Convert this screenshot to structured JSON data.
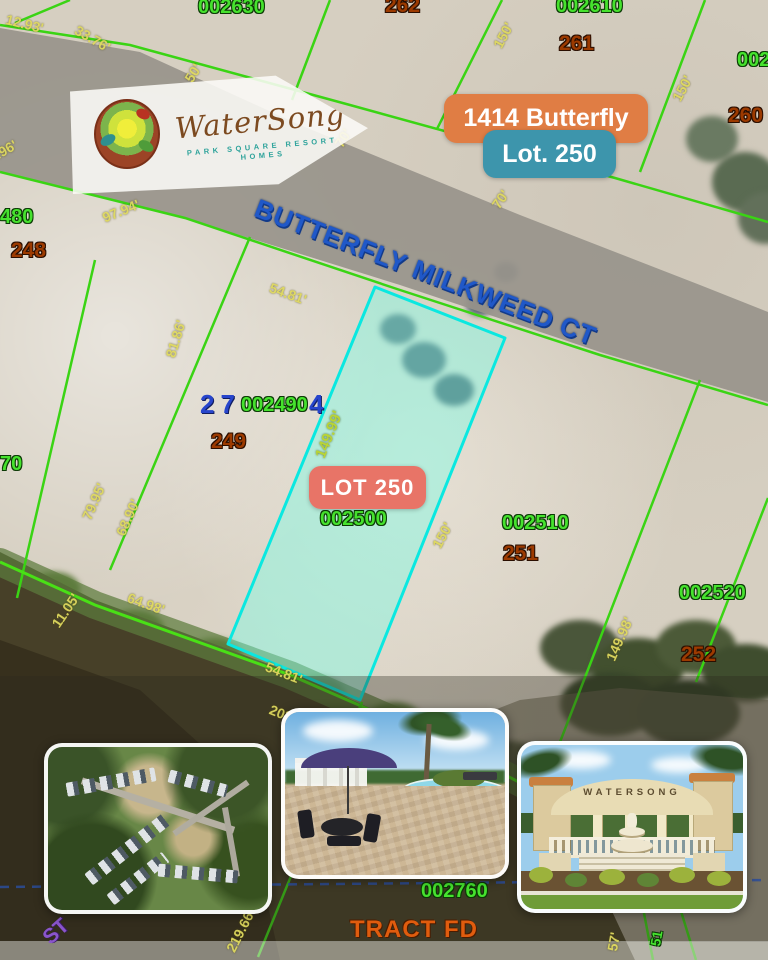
{
  "banner": {
    "brand": "WaterSong",
    "tagline": "PARK SQUARE RESORT HOMES"
  },
  "callouts": {
    "address": "1414 Butterfly",
    "lot": "Lot. 250",
    "lot_marker": "LOT 250"
  },
  "street": {
    "name": "BUTTERFLY MILKWEED CT"
  },
  "photos": {
    "entrance_sign": "WATERSONG"
  },
  "colors": {
    "accent_orange": "#e07d44",
    "accent_teal": "#3d95ac",
    "lot_marker_red": "#ec6a5e",
    "parcel_green": "#3ad414",
    "highlight_cyan": "#0ae8e0",
    "street_blue": "#2058c8",
    "dim_yellow": "#ded85e",
    "lot_number_brown": "#9c3a00",
    "road_gray": "#98948b"
  },
  "map_labels": [
    {
      "text": "002630",
      "x": 198,
      "y": -3,
      "cls": "p",
      "name": "parcel-id-002630"
    },
    {
      "text": "262",
      "x": 385,
      "y": -5,
      "cls": "n",
      "name": "lot-number-262"
    },
    {
      "text": "002610",
      "x": 556,
      "y": -4,
      "cls": "p",
      "name": "parcel-id-002610"
    },
    {
      "text": "261",
      "x": 559,
      "y": 33,
      "cls": "n",
      "name": "lot-number-261"
    },
    {
      "text": "002",
      "x": 737,
      "y": 50,
      "cls": "p",
      "name": "parcel-id-partial-right"
    },
    {
      "text": "260",
      "x": 728,
      "y": 105,
      "cls": "n",
      "name": "lot-number-260"
    },
    {
      "text": "480",
      "x": 0,
      "y": 207,
      "cls": "p",
      "name": "parcel-id-partial-480"
    },
    {
      "text": "248",
      "x": 11,
      "y": 240,
      "cls": "n",
      "name": "lot-number-248"
    },
    {
      "text": "70",
      "x": 0,
      "y": 454,
      "cls": "p",
      "name": "parcel-id-partial-70"
    },
    {
      "text": "27",
      "x": 200,
      "y": 391,
      "cls": "b",
      "name": "overlap-blue-27"
    },
    {
      "text": "002490",
      "x": 241,
      "y": 395,
      "cls": "p",
      "name": "parcel-id-002490"
    },
    {
      "text": "4",
      "x": 309,
      "y": 391,
      "cls": "b",
      "name": "overlap-blue-4"
    },
    {
      "text": "249",
      "x": 211,
      "y": 431,
      "cls": "n",
      "name": "lot-number-249"
    },
    {
      "text": "002500",
      "x": 320,
      "y": 509,
      "cls": "p",
      "name": "parcel-id-002500"
    },
    {
      "text": "002510",
      "x": 502,
      "y": 513,
      "cls": "p",
      "name": "parcel-id-002510"
    },
    {
      "text": "251",
      "x": 503,
      "y": 543,
      "cls": "n",
      "name": "lot-number-251"
    },
    {
      "text": "002520",
      "x": 679,
      "y": 583,
      "cls": "p",
      "name": "parcel-id-002520"
    },
    {
      "text": "252",
      "x": 681,
      "y": 644,
      "cls": "n",
      "name": "lot-number-252"
    },
    {
      "text": "002760",
      "x": 421,
      "y": 881,
      "cls": "p",
      "name": "parcel-id-002760"
    },
    {
      "text": "TRACT FD",
      "x": 350,
      "y": 918,
      "cls": "t",
      "name": "tract-label"
    },
    {
      "text": "ST",
      "x": 46,
      "y": 930,
      "cls": "v",
      "rot": -42,
      "name": "street-partial-label"
    },
    {
      "text": "BUTTERFLY MILKWEED CT",
      "x": 256,
      "y": 194,
      "cls": "s",
      "rot": 21,
      "name": "street-name-label"
    },
    {
      "text": "12.93'",
      "x": 6,
      "y": 12,
      "cls": "d",
      "rot": 14,
      "name": "dim-12-93"
    },
    {
      "text": "33.76'",
      "x": 76,
      "y": 22,
      "cls": "d",
      "rot": 30,
      "name": "dim-33-76"
    },
    {
      "text": "50'",
      "x": 188,
      "y": 74,
      "cls": "d",
      "rot": -58,
      "name": "dim-50"
    },
    {
      "text": "70'",
      "x": 338,
      "y": 139,
      "cls": "d",
      "rot": -58,
      "name": "dim-70-a"
    },
    {
      "text": "70'",
      "x": 495,
      "y": 200,
      "cls": "d",
      "rot": -55,
      "name": "dim-70-b"
    },
    {
      "text": "150'",
      "x": 497,
      "y": 40,
      "cls": "d",
      "rot": -62,
      "name": "dim-150-a"
    },
    {
      "text": "150'",
      "x": 676,
      "y": 93,
      "cls": "d",
      "rot": -62,
      "name": "dim-150-b"
    },
    {
      "text": ".96'",
      "x": -4,
      "y": 148,
      "cls": "d",
      "rot": -30,
      "name": "dim-96-partial"
    },
    {
      "text": "97.94'",
      "x": 103,
      "y": 211,
      "cls": "d",
      "rot": -22,
      "name": "dim-97-94"
    },
    {
      "text": "54.81'",
      "x": 270,
      "y": 280,
      "cls": "d",
      "rot": 20,
      "name": "dim-54-81-top"
    },
    {
      "text": "149.99'",
      "x": 320,
      "y": 450,
      "cls": "g",
      "rot": -68,
      "name": "dim-149-99"
    },
    {
      "text": "150'",
      "x": 436,
      "y": 540,
      "cls": "d",
      "rot": -62,
      "name": "dim-150-c"
    },
    {
      "text": "149.98'",
      "x": 610,
      "y": 653,
      "cls": "d",
      "rot": -66,
      "name": "dim-149-98"
    },
    {
      "text": "79.95'",
      "x": 86,
      "y": 512,
      "cls": "d",
      "rot": -66,
      "name": "dim-79-95"
    },
    {
      "text": "68.90'",
      "x": 120,
      "y": 528,
      "cls": "d",
      "rot": -66,
      "name": "dim-68-90"
    },
    {
      "text": "81.86'",
      "x": 170,
      "y": 350,
      "cls": "d",
      "rot": -73,
      "name": "dim-81-86"
    },
    {
      "text": "64.98'",
      "x": 128,
      "y": 590,
      "cls": "d",
      "rot": 20,
      "name": "dim-64-98"
    },
    {
      "text": "11.05'",
      "x": 55,
      "y": 619,
      "cls": "d",
      "rot": -56,
      "name": "dim-11-05"
    },
    {
      "text": "54.81'",
      "x": 266,
      "y": 659,
      "cls": "d",
      "rot": 21,
      "name": "dim-54-81-bottom"
    },
    {
      "text": "203.06'",
      "x": 270,
      "y": 702,
      "cls": "d",
      "rot": 21,
      "name": "dim-203-06"
    },
    {
      "text": "219.66'",
      "x": 230,
      "y": 944,
      "cls": "d",
      "rot": -63,
      "name": "dim-219-66"
    },
    {
      "text": "57'",
      "x": 612,
      "y": 944,
      "cls": "d",
      "rot": -80,
      "name": "dim-57-partial"
    },
    {
      "text": "51",
      "x": 655,
      "y": 939,
      "cls": "p",
      "rot": -80,
      "size": 14,
      "name": "parcel-partial-51"
    }
  ],
  "map_shapes": [
    {
      "type": "polygon",
      "points": "0,28 140,52 300,125 520,215 700,285 768,312 768,402 600,352 400,285 185,218 0,172",
      "fill": "#98948b",
      "opacity": ".92",
      "name": "road-surface"
    },
    {
      "type": "polygon",
      "points": "0,552 95,600 290,672 430,735 562,805 635,960 0,960",
      "fill": "#474028",
      "name": "lake-area"
    },
    {
      "type": "polygon",
      "points": "0,640 140,690 240,780 280,960 0,960",
      "fill": "#37301d",
      "name": "lake-deep-area"
    },
    {
      "type": "polygon",
      "points": "430,735 562,805 635,960 768,960 768,700 620,688 520,700",
      "fill": "#6a6550",
      "opacity": ".55",
      "name": "bottom-right-ground"
    },
    {
      "type": "polyline",
      "points": "0,562 95,605 290,675 432,737 565,806",
      "stroke": "#5d7b3d",
      "w": "28",
      "opacity": ".72",
      "linejoin": "round",
      "cap": "round",
      "name": "shore-vegetation-band"
    },
    {
      "type": "line",
      "x1": 70,
      "y1": 0,
      "x2": 15,
      "y2": 23,
      "stroke": "#3ad414",
      "w": "2.5",
      "name": "parcel-line"
    },
    {
      "type": "polyline",
      "points": "0,25 130,45 350,105 615,178 768,222",
      "stroke": "#3ad414",
      "w": "2.5",
      "name": "road-north-frontage-line"
    },
    {
      "type": "polyline",
      "points": "0,172 185,218 400,290 600,355 768,405",
      "stroke": "#3ad414",
      "w": "2.5",
      "name": "road-south-frontage-line"
    },
    {
      "type": "line",
      "x1": 330,
      "y1": 0,
      "x2": 292,
      "y2": 100,
      "stroke": "#3ad414",
      "w": "2.5",
      "name": "parcel-line"
    },
    {
      "type": "line",
      "x1": 502,
      "y1": 0,
      "x2": 437,
      "y2": 129,
      "stroke": "#3ad414",
      "w": "2.5",
      "name": "parcel-line"
    },
    {
      "type": "line",
      "x1": 705,
      "y1": 0,
      "x2": 640,
      "y2": 172,
      "stroke": "#3ad414",
      "w": "2.5",
      "name": "parcel-line"
    },
    {
      "type": "line",
      "x1": 95,
      "y1": 260,
      "x2": 17,
      "y2": 598,
      "stroke": "#3ad414",
      "w": "2.5",
      "name": "parcel-line"
    },
    {
      "type": "line",
      "x1": 250,
      "y1": 237,
      "x2": 110,
      "y2": 570,
      "stroke": "#3ad414",
      "w": "2.5",
      "name": "parcel-line"
    },
    {
      "type": "line",
      "x1": 700,
      "y1": 380,
      "x2": 560,
      "y2": 742,
      "stroke": "#3ad414",
      "w": "2.5",
      "name": "parcel-line"
    },
    {
      "type": "line",
      "x1": 768,
      "y1": 498,
      "x2": 696,
      "y2": 682,
      "stroke": "#3ad414",
      "w": "2.5",
      "name": "parcel-line"
    },
    {
      "type": "polyline",
      "points": "0,562 95,605 290,675 432,737 565,806",
      "stroke": "#49e016",
      "w": "3",
      "name": "shoreline-parcel-line"
    },
    {
      "type": "line",
      "x1": 362,
      "y1": 702,
      "x2": 258,
      "y2": 957,
      "stroke": "#3ad414",
      "w": "2.5",
      "name": "parcel-line"
    },
    {
      "type": "line",
      "x1": 643,
      "y1": 908,
      "x2": 653,
      "y2": 960,
      "stroke": "#3ad414",
      "w": "2.5",
      "name": "parcel-line"
    },
    {
      "type": "line",
      "x1": 680,
      "y1": 908,
      "x2": 696,
      "y2": 960,
      "stroke": "#3ad414",
      "w": "2.5",
      "name": "parcel-line"
    },
    {
      "type": "line",
      "x1": 0,
      "y1": 887,
      "x2": 768,
      "y2": 880,
      "stroke": "#2b5fd8",
      "w": "2.5",
      "dash": "9 7",
      "opacity": ".85",
      "name": "boundary-dashed-line"
    },
    {
      "type": "polygon",
      "points": "375,287 505,338 360,700 228,644",
      "fill": "rgba(120,255,230,.42)",
      "stroke": "#0ae8e0",
      "w": "3",
      "linejoin": "round",
      "name": "highlighted-lot-250"
    }
  ]
}
